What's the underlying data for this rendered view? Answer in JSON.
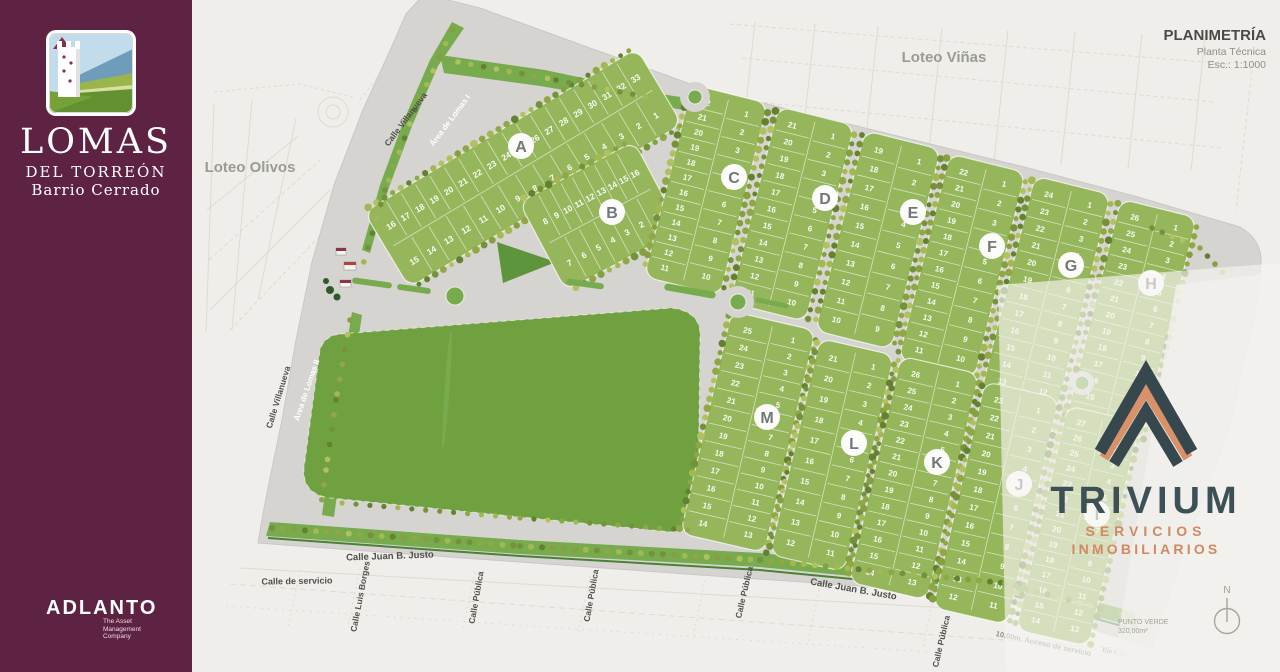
{
  "colors": {
    "sidebar_maroon": "#5e2242",
    "paper": "#efeeea",
    "road_gray": "#d5d4d0",
    "lot_green": "#96b65c",
    "park_green": "#6fa141",
    "dark_green": "#5e953c",
    "verge_green": "#78aa4e",
    "trivium_slate": "#36474d",
    "trivium_orange": "#d9916a",
    "badge_letter_gray": "#73777a",
    "street_label_gray": "#4f4f4b",
    "muted_label_gray": "#9b9b95"
  },
  "sidebar": {
    "brand": {
      "title": "LOMAS",
      "subtitle": "DEL TORREÓN",
      "tagline": "Barrio Cerrado",
      "logo": "tower-hills-illustration"
    },
    "footer": {
      "name": "ADLANTO",
      "tagline_line1": "The Asset",
      "tagline_line2": "Management",
      "tagline_line3": "Company"
    }
  },
  "map": {
    "title_block": {
      "title": "PLANIMETRÍA",
      "subtitle": "Planta Técnica",
      "scale": "Esc.: 1:1000"
    },
    "context_labels": [
      {
        "id": "loteo-olivos",
        "text": "Loteo Olivos"
      },
      {
        "id": "loteo-vinas",
        "text": "Loteo Viñas"
      }
    ],
    "street_labels": [
      {
        "id": "villanueva-top",
        "text": "Calle Villanueva"
      },
      {
        "id": "area-lomas-1",
        "text": "Área de Lomas I"
      },
      {
        "id": "villanueva-left",
        "text": "Calle Villanueva"
      },
      {
        "id": "area-lomas-2",
        "text": "Área de Lomas II"
      },
      {
        "id": "juan-b-justo-1",
        "text": "Calle Juan B. Justo"
      },
      {
        "id": "calle-servicio",
        "text": "Calle de servicio"
      },
      {
        "id": "luis-borges",
        "text": "Calle Luis Borges"
      },
      {
        "id": "publica-1",
        "text": "Calle Pública"
      },
      {
        "id": "publica-2",
        "text": "Calle Pública"
      },
      {
        "id": "publica-3",
        "text": "Calle Pública"
      },
      {
        "id": "juan-b-justo-2",
        "text": "Calle Juan B. Justo"
      },
      {
        "id": "publica-4",
        "text": "Calle Pública"
      },
      {
        "id": "acceso-servicio",
        "text": "10.00m. Acceso de servicio"
      },
      {
        "id": "eje",
        "text": "Eje 0,00"
      }
    ],
    "annotations": {
      "punto_verde_line1": "PUNTO VERDE",
      "punto_verde_line2": "320,00m²",
      "north": "N"
    },
    "blocks": [
      {
        "letter": "A",
        "lots": 33,
        "right_col": 15
      },
      {
        "letter": "B",
        "lots": 16,
        "right_col": 7
      },
      {
        "letter": "C",
        "lots": 22,
        "right_col": 10
      },
      {
        "letter": "D",
        "lots": 21,
        "right_col": 10
      },
      {
        "letter": "E",
        "lots": 19,
        "right_col": 9
      },
      {
        "letter": "F",
        "lots": 22,
        "right_col": 10
      },
      {
        "letter": "G",
        "lots": 24,
        "right_col": 12
      },
      {
        "letter": "H",
        "lots": 26,
        "right_col": 13
      },
      {
        "letter": "M",
        "lots": 25,
        "right_col": 13
      },
      {
        "letter": "L",
        "lots": 21,
        "right_col": 11
      },
      {
        "letter": "K",
        "lots": 26,
        "right_col": 13
      },
      {
        "letter": "J",
        "lots": 23,
        "right_col": 11
      },
      {
        "letter": "I",
        "lots": 27,
        "right_col": 13
      }
    ]
  },
  "watermark": {
    "brand": "TRIVIUM",
    "line1": "SERVICIOS",
    "line2": "INMOBILIARIOS"
  }
}
